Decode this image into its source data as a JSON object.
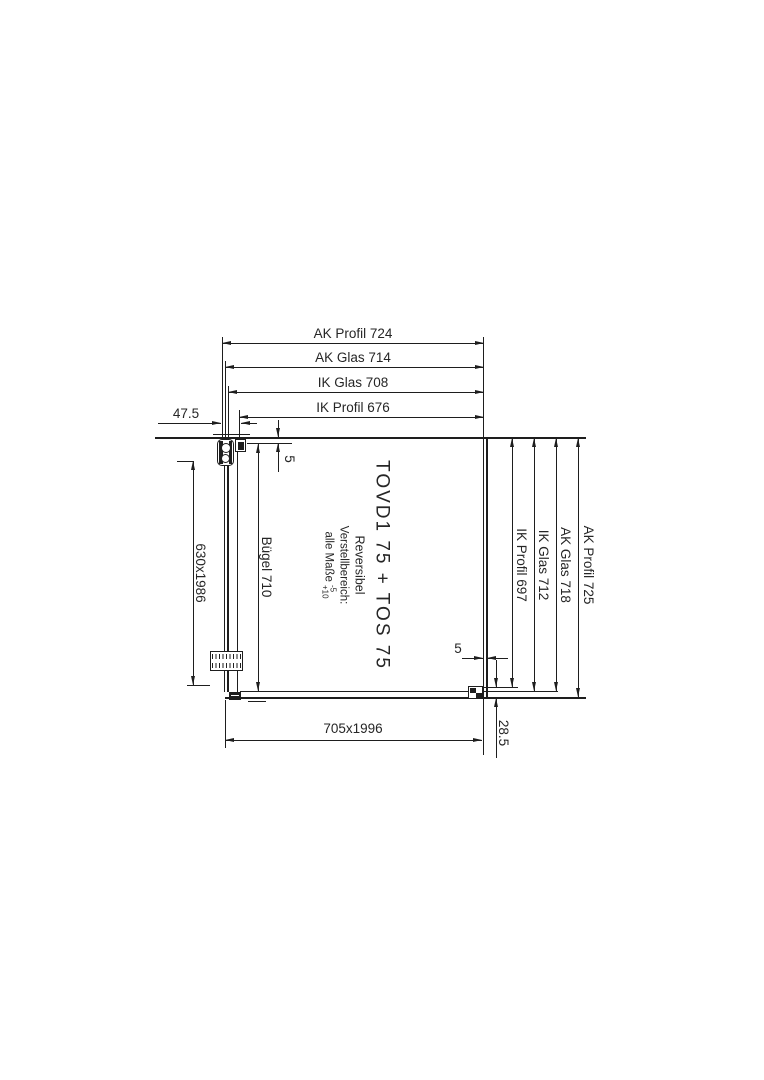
{
  "labels": {
    "top_ak_profil": "AK Profil 724",
    "top_ak_glas": "AK Glas 714",
    "top_ik_glas": "IK Glas 708",
    "top_ik_profil": "IK Profil 676",
    "left_offset": "47.5",
    "left_glass_size": "630x1986",
    "left_buegel": "Bügel 710",
    "gap_top_left": "5",
    "gap_bottom_right": "5",
    "right_ik_profil": "IK Profil 697",
    "right_ik_glas": "IK Glas 712",
    "right_ak_glas": "AK Glas 718",
    "right_ak_profil": "AK Profil 725",
    "bottom_size": "705x1996",
    "bottom_offset": "28.5"
  },
  "center": {
    "title": "TOVD1 75 + TOS 75",
    "subtitle": "Reversibel",
    "range_label": "Verstellbereich:",
    "range_prefix": "alle Maße",
    "tol_upper": "-5",
    "tol_lower": "+10"
  },
  "colors": {
    "line": "#1e1e1e",
    "text": "#262626",
    "background": "#ffffff"
  }
}
